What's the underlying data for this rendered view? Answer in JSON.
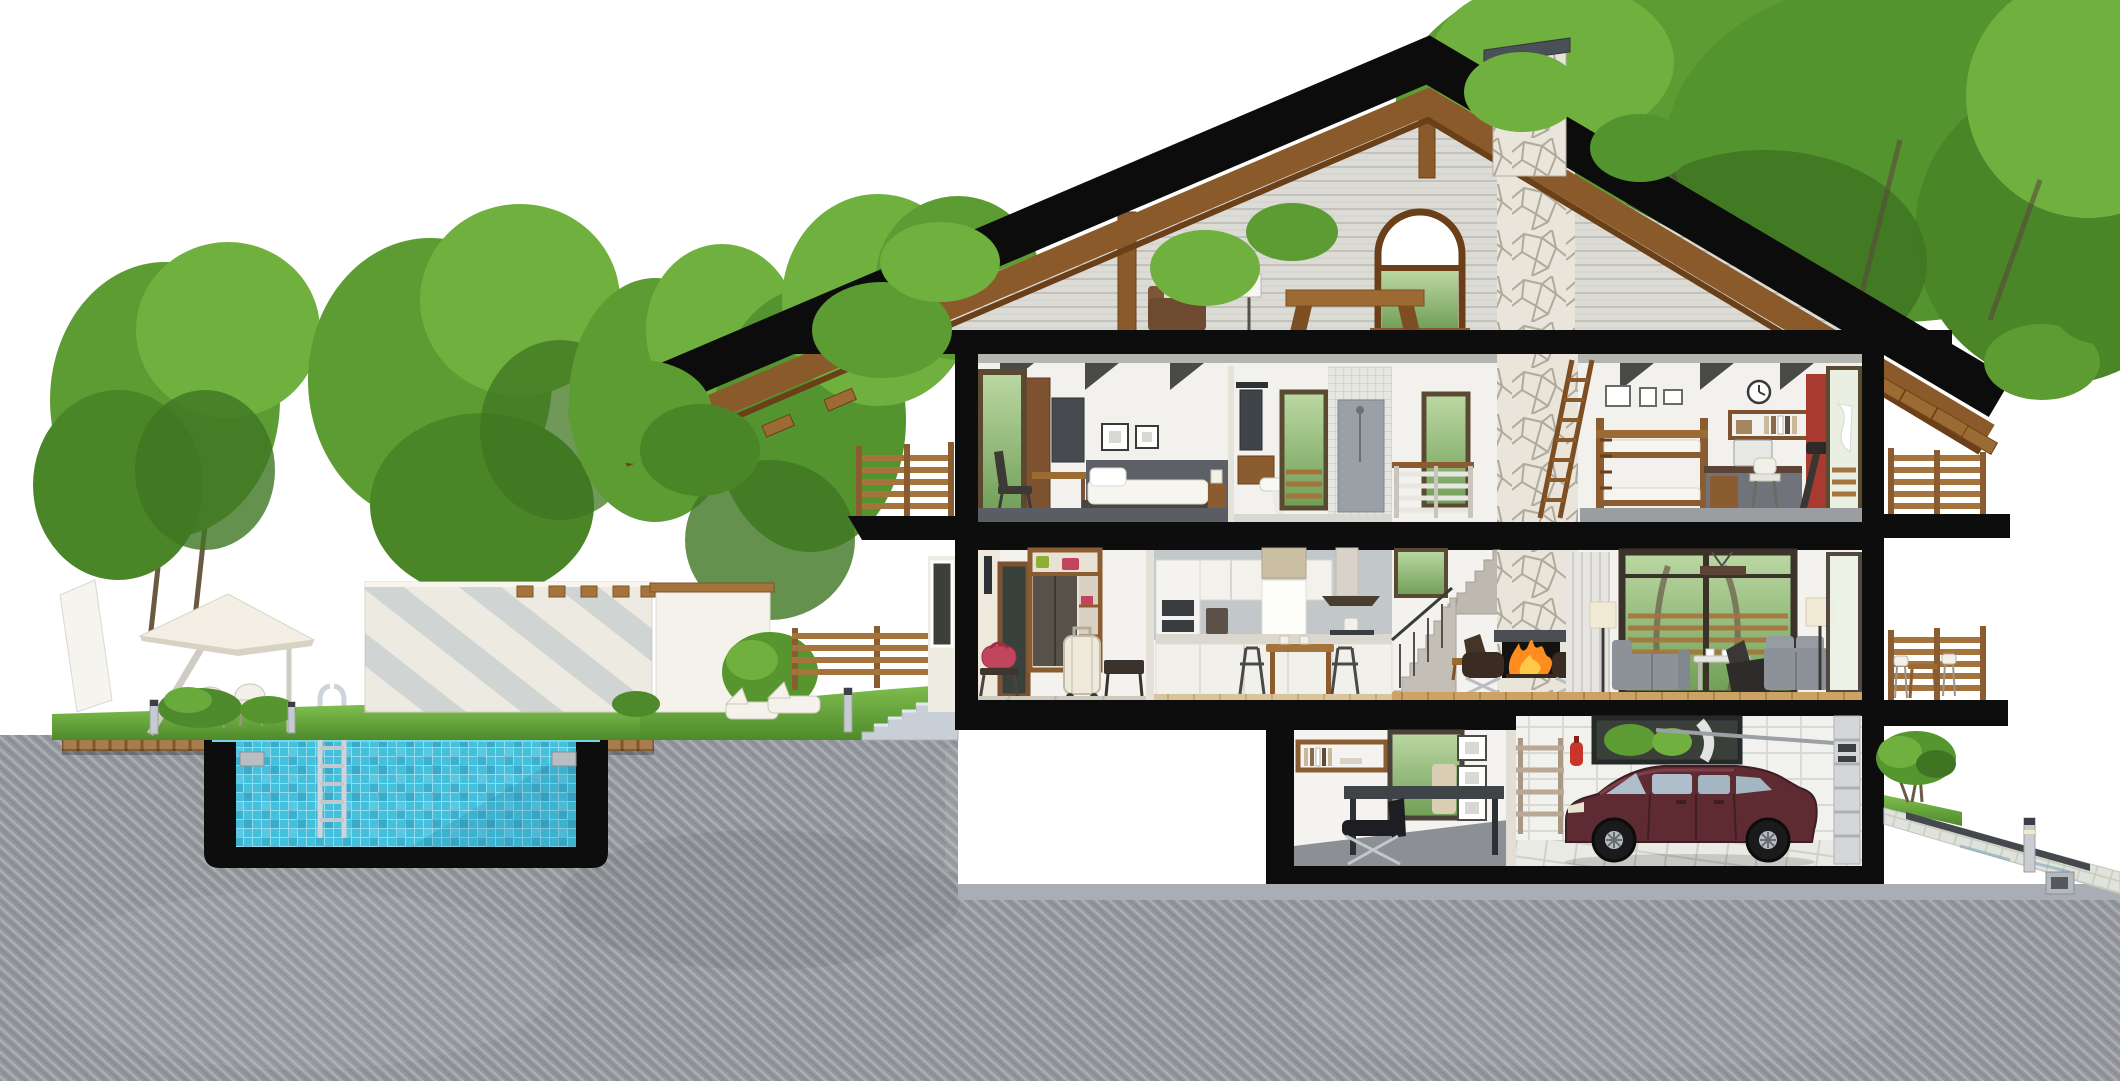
{
  "scene": {
    "description": "Cutaway cross-section rendering of a two-storey house with attic and basement garage, outdoor swimming pool shown in section, landscaped garden, white background",
    "style": "photorealistic architectural cutaway illustration",
    "levels": [
      {
        "name": "attic",
        "objects": [
          "exposed timber roof structure",
          "king post",
          "arched gable window",
          "floor lamp",
          "wooden bench",
          "brown armchair",
          "stone chimney"
        ]
      },
      {
        "name": "upper-floor",
        "rooms": [
          {
            "name": "bedroom",
            "objects": [
              "balcony glass door",
              "wardrobe",
              "desk with chair",
              "two framed pictures",
              "dark accent wall",
              "double bed",
              "bedside table with lamp"
            ]
          },
          {
            "name": "bathroom",
            "objects": [
              "mirror with light bar",
              "wooden vanity",
              "washbasin",
              "tall garden window",
              "grey walk-in shower"
            ]
          },
          {
            "name": "stair-hall",
            "objects": [
              "stair railing",
              "window",
              "wooden loft ladder against chimney"
            ]
          },
          {
            "name": "kids-room",
            "objects": [
              "bunk bed",
              "three picture frames",
              "wall clock",
              "book shelf",
              "computer desk with chair",
              "treadmill",
              "red column",
              "open balcony door"
            ]
          }
        ]
      },
      {
        "name": "ground-floor",
        "rooms": [
          {
            "name": "entry-hall",
            "objects": [
              "outdoor wall lamp",
              "front door",
              "wardrobe with green and pink bags",
              "white suitcase",
              "pink duffel bag on stool",
              "dark bench"
            ]
          },
          {
            "name": "kitchen",
            "objects": [
              "tall oven cabinet",
              "upper cabinets",
              "window with roller blind",
              "extractor hood",
              "coffee machine",
              "kettle",
              "counter with base cabinets",
              "dining table with two wire chairs"
            ]
          },
          {
            "name": "stair-hall",
            "objects": [
              "two concrete stair flights",
              "window over stairs"
            ]
          },
          {
            "name": "living-room",
            "objects": [
              "stone fireplace with burning fire",
              "two dark leather lounge chairs",
              "side bench",
              "grey curtain",
              "two cream floor lamps",
              "two grey sofas",
              "white coffee table",
              "black easy chair",
              "panoramic window with tree view",
              "timber pendant light",
              "plank floor"
            ]
          }
        ]
      },
      {
        "name": "basement",
        "rooms": [
          {
            "name": "home-office",
            "objects": [
              "wall book shelf",
              "window to light well",
              "dark desk",
              "black leather lounge chair",
              "three stacked picture frames"
            ]
          },
          {
            "name": "garage",
            "objects": [
              "metal storage rack",
              "red fire extinguisher",
              "ribbon window",
              "dark red sedan car",
              "sectional garage door",
              "door opener rail",
              "white tiled walls and floor"
            ]
          }
        ]
      }
    ],
    "exterior": {
      "left_garden": [
        "large leafy trees",
        "cantilever parasol",
        "two white garden chairs",
        "bushes",
        "cream garden wall with diagonal blue-grey stripes and timber brackets",
        "second white garden wall with timber cap",
        "white sun loungers",
        "bollard lights",
        "timber pool deck",
        "stone entrance steps",
        "horizontal slatted timber fence"
      ],
      "pool": [
        "swimming pool shown in section",
        "cyan mosaic tile lining",
        "stainless steel ladder",
        "black concrete shell",
        "corner anchor plates",
        "water surface band"
      ],
      "right_yard": [
        "upper and lower balconies with timber slat railings",
        "terrace table and chairs",
        "small round tree on grass",
        "sloping paved driveway",
        "dark drain channel",
        "bollard light",
        "drain pipe outlet"
      ],
      "underground": "grey concrete earth mass with diagonal hatching"
    },
    "house": {
      "storeys_visible": 4,
      "roof": "black-edged pitched roof with timber underside and rafter tails",
      "chimney": "natural stone with dark cap"
    }
  },
  "palette": {
    "section_cut": "#0d0d0d",
    "earth": "#94979c",
    "pool_water": "#74d6e9",
    "pool_tile": "#45c0dc",
    "deck_wood": "#a87c4c",
    "roof_wood": "#8a5a2b",
    "grass": "#66a83c",
    "foliage": "#5c9c33",
    "wall_interior": "#f2f1ec",
    "stone": "#e9e5da",
    "car_body": "#5e2b33",
    "fire": "#ff8c1f",
    "accent_red": "#c8352a",
    "accent_pink": "#c2455e",
    "sofa_grey": "#8d9298"
  }
}
